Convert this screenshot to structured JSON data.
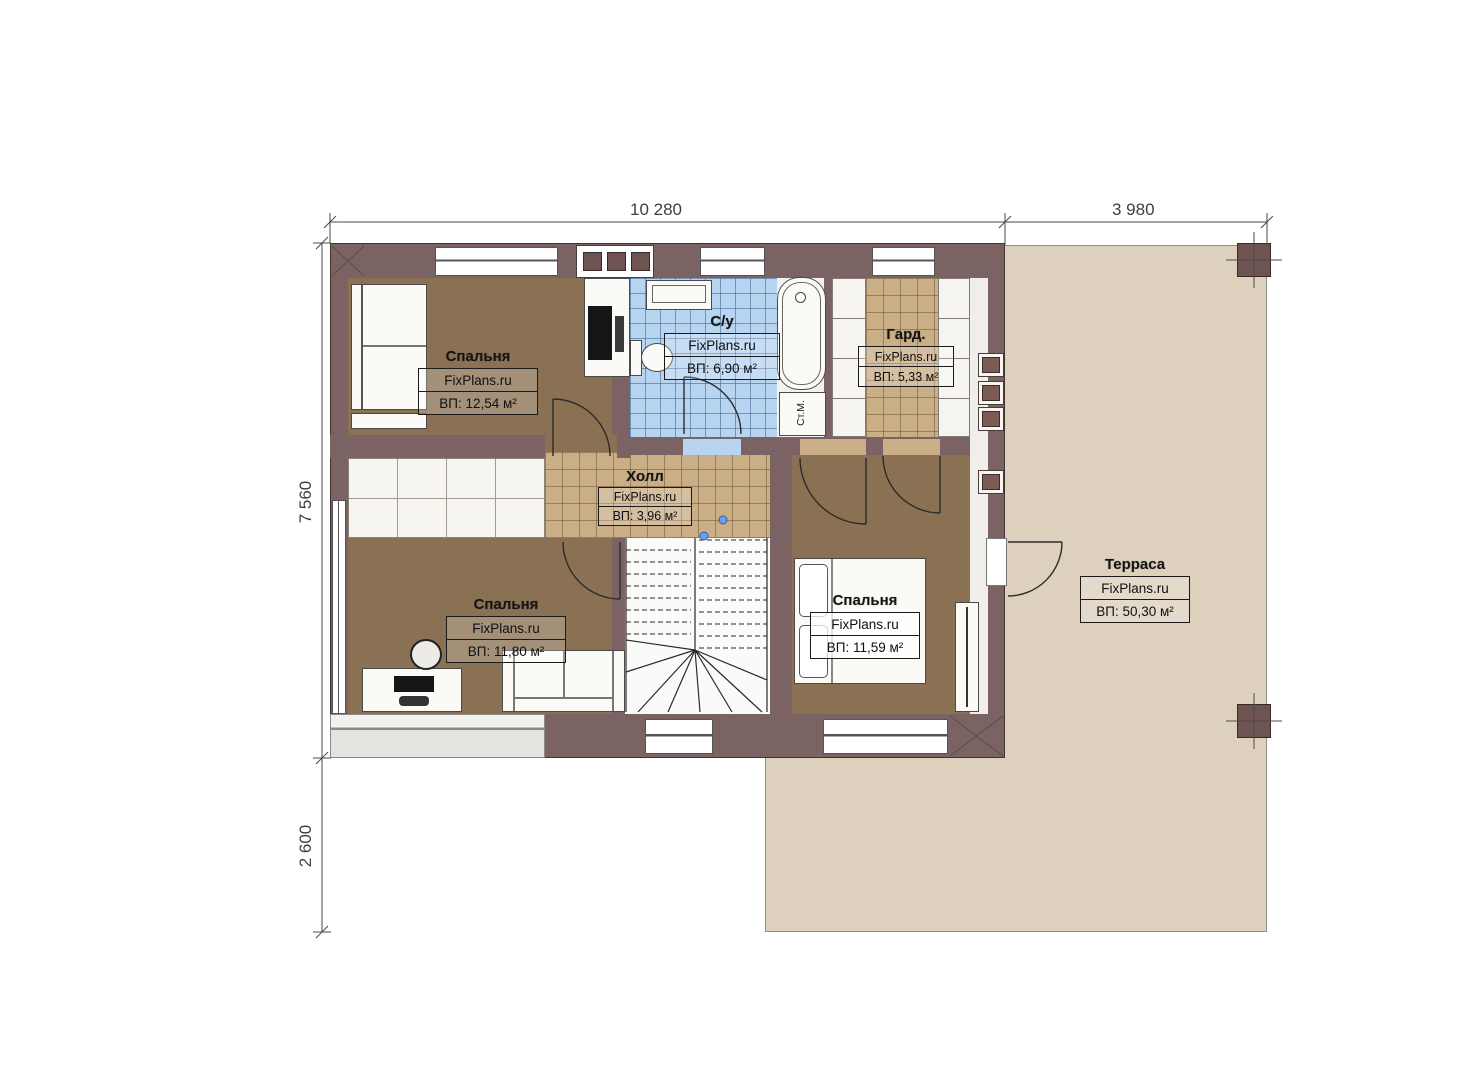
{
  "document_type": "floor-plan",
  "dimensions": {
    "top_main": "10 280",
    "top_terrace": "3 980",
    "left_main": "7 560",
    "left_lower": "2 600"
  },
  "rooms": {
    "bedroom1": {
      "name": "Спальня",
      "brand": "FixPlans.ru",
      "area": "ВП: 12,54 м²"
    },
    "bathroom": {
      "name": "С/у",
      "brand": "FixPlans.ru",
      "area": "ВП: 6,90 м²"
    },
    "wardrobe": {
      "name": "Гард.",
      "brand": "FixPlans.ru",
      "area": "ВП: 5,33 м²"
    },
    "hall": {
      "name": "Холл",
      "brand": "FixPlans.ru",
      "area": "ВП: 3,96 м²"
    },
    "bedroom2": {
      "name": "Спальня",
      "brand": "FixPlans.ru",
      "area": "ВП: 11,80 м²"
    },
    "bedroom3": {
      "name": "Спальня",
      "brand": "FixPlans.ru",
      "area": "ВП: 11,59 м²"
    },
    "terrace": {
      "name": "Терраса",
      "brand": "FixPlans.ru",
      "area": "ВП: 50,30 м²"
    }
  },
  "annotations": {
    "washing_machine": "Ст.М."
  },
  "colors": {
    "wall": "#7c6363",
    "bedroom_floor": "#8b7154",
    "tile_tan": "#c9ae86",
    "tile_blue": "#b7d4f0",
    "terrace": "#ddd0bd"
  }
}
